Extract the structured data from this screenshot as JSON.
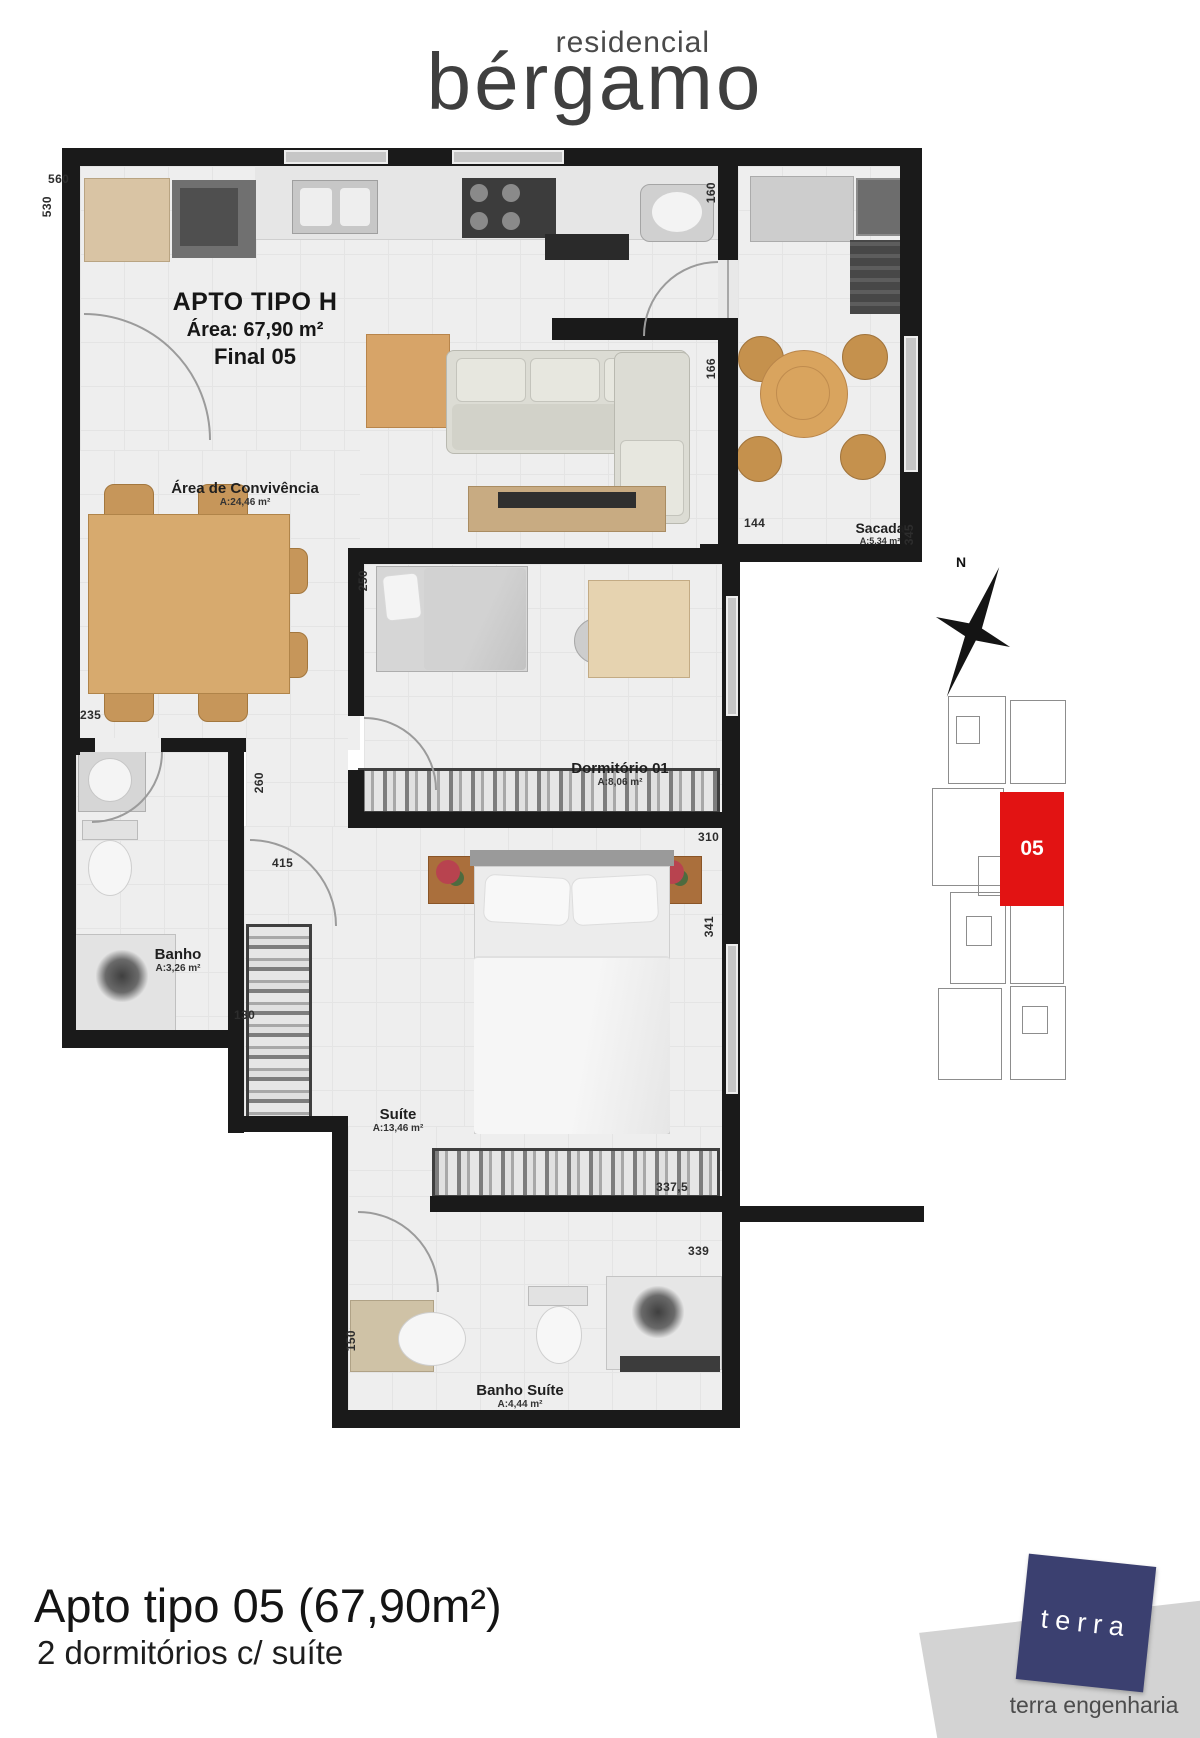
{
  "logo": {
    "small": "residencial",
    "large": "bérgamo"
  },
  "unit": {
    "title": "APTO TIPO H",
    "area": "Área: 67,90 m²",
    "final": "Final 05"
  },
  "rooms": [
    {
      "name": "Área de Convivência",
      "area": "A:24,46 m²"
    },
    {
      "name": "Sacada",
      "area": "A:5,34 m²"
    },
    {
      "name": "Dormitório 01",
      "area": "A:8,06 m²"
    },
    {
      "name": "Banho",
      "area": "A:3,26 m²"
    },
    {
      "name": "Suíte",
      "area": "A:13,46 m²"
    },
    {
      "name": "Banho Suíte",
      "area": "A:4,44 m²"
    }
  ],
  "dims": [
    "560",
    "530",
    "160",
    "166",
    "144",
    "345",
    "250",
    "235",
    "260",
    "310",
    "415",
    "341",
    "130",
    "337,5",
    "339",
    "150"
  ],
  "compass": {
    "north": "N"
  },
  "keyplan": {
    "unit": "05",
    "highlight_color": "#e21313"
  },
  "footer": {
    "title": "Apto tipo 05 (67,90m²)",
    "subtitle": "2 dormitórios c/ suíte"
  },
  "brand": {
    "logo": "terra",
    "name": "terra engenharia",
    "color": "#3b4070"
  }
}
